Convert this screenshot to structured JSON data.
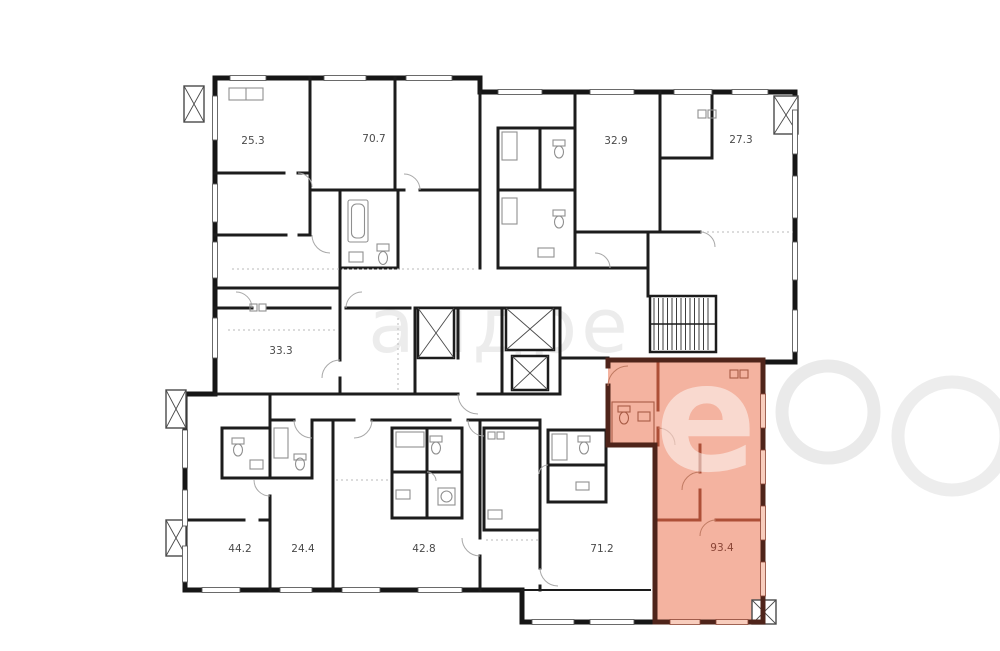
{
  "plan": {
    "type": "residential-floor-plan",
    "apartments": [
      {
        "area": "25.3",
        "highlighted": false
      },
      {
        "area": "70.7",
        "highlighted": false
      },
      {
        "area": "32.9",
        "highlighted": false
      },
      {
        "area": "27.3",
        "highlighted": false
      },
      {
        "area": "33.3",
        "highlighted": false
      },
      {
        "area": "44.2",
        "highlighted": false
      },
      {
        "area": "24.4",
        "highlighted": false
      },
      {
        "area": "42.8",
        "highlighted": false
      },
      {
        "area": "71.2",
        "highlighted": false
      },
      {
        "area": "93.4",
        "highlighted": true
      }
    ],
    "colors": {
      "highlight_fill": "#f2a28b",
      "highlight_wall": "#4f241a",
      "wall": "#161616",
      "fixture": "#8f8f8f",
      "label": "#4a4a4a"
    },
    "watermark": {
      "fragment": "андре",
      "letter": "е"
    }
  }
}
